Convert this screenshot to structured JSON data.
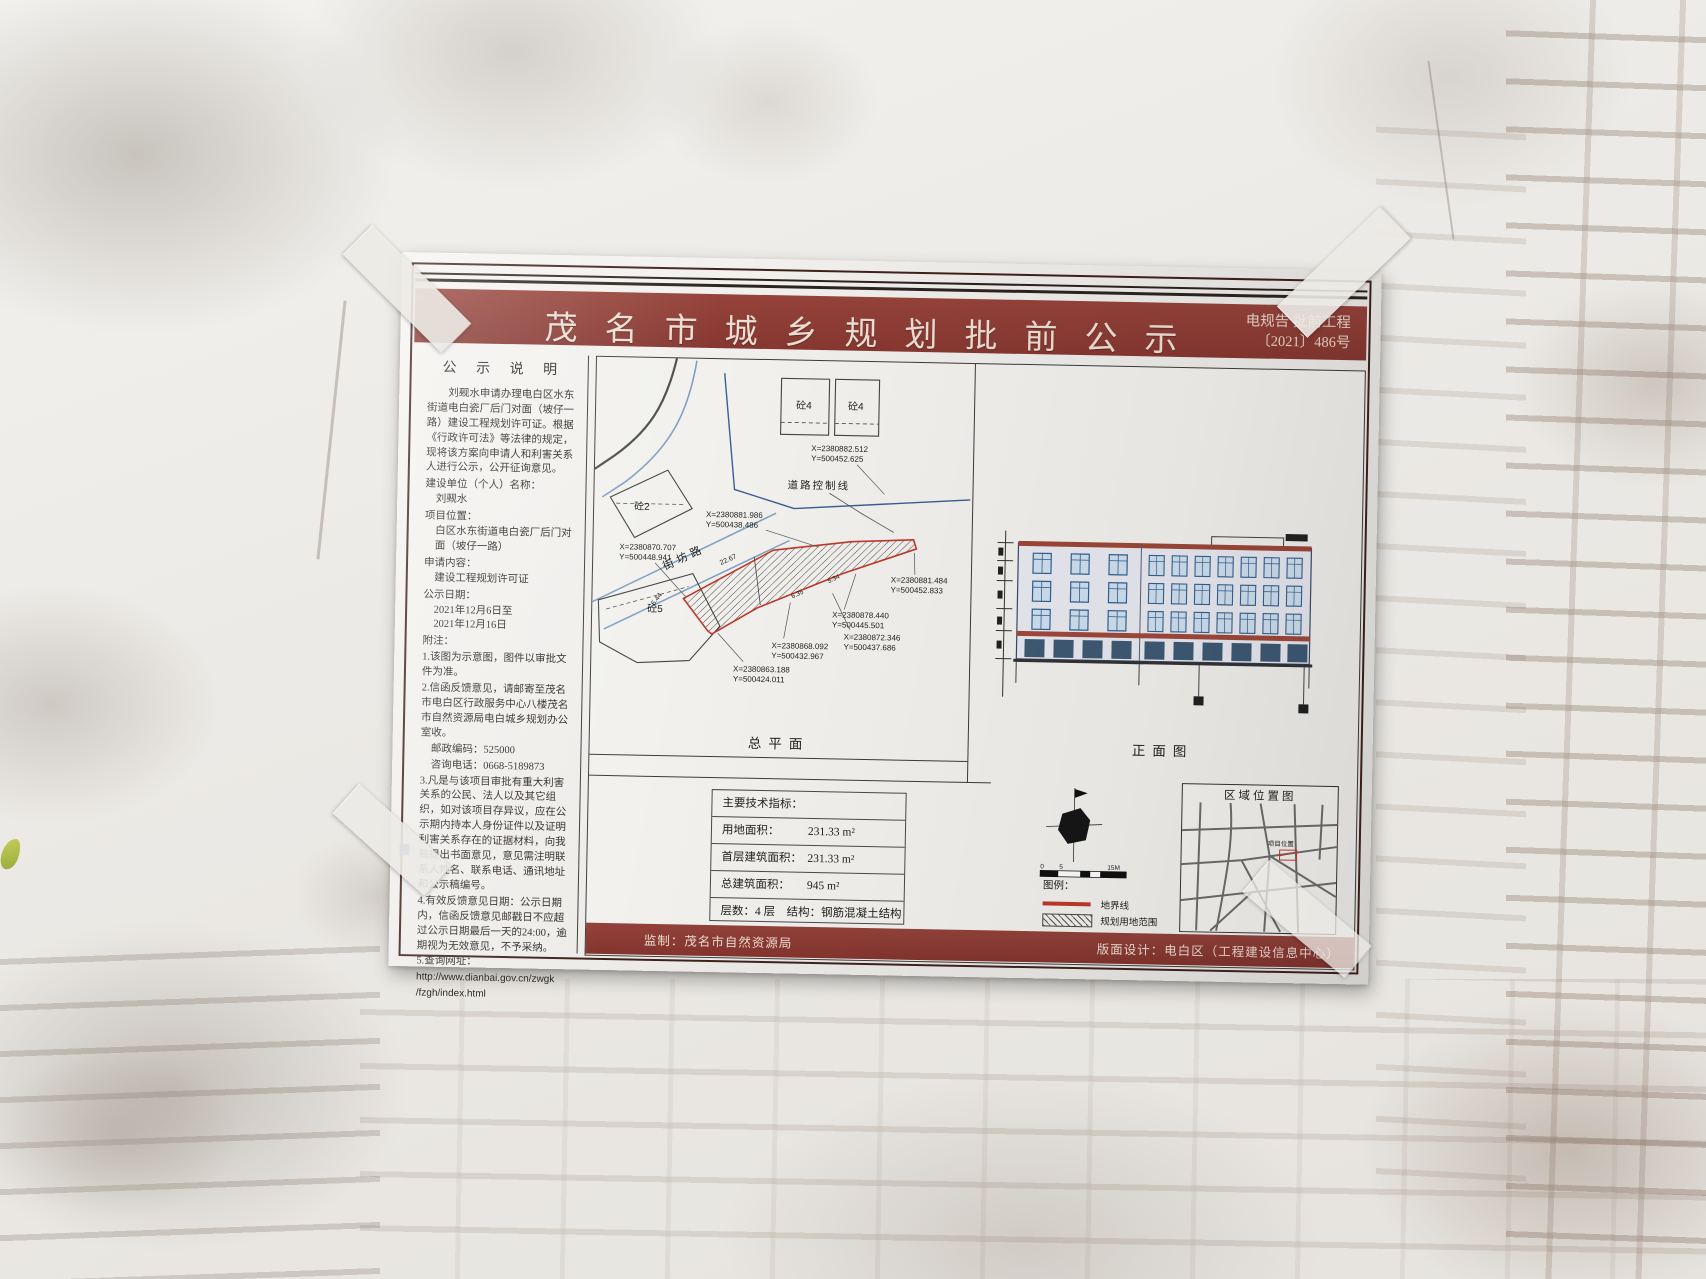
{
  "header": {
    "title": "茂名市城乡规划批前公示",
    "doc_line1": "电规告 批前工程",
    "doc_line2": "〔2021〕486号"
  },
  "left": {
    "heading": "公 示 说 明",
    "intro": "刘觋水申请办理电白区水东街道电白瓷厂后门对面（坡仔一路）建设工程规划许可证。根据《行政许可法》等法律的规定，现将该方案向申请人和利害关系人进行公示，公开征询意见。",
    "unit_label": "建设单位（个人）名称：",
    "unit_value": "刘觋水",
    "loc_label": "项目位置：",
    "loc_value": "白区水东街道电白瓷厂后门对面（坡仔一路）",
    "content_label": "申请内容：",
    "content_value": "建设工程规划许可证",
    "date_label": "公示日期：",
    "date_value1": "2021年12月6日至",
    "date_value2": "2021年12月16日",
    "notes_title": "附注：",
    "notes": [
      "1.该图为示意图，图件以审批文件为准。",
      "2.信函反馈意见，请邮寄至茂名市电白区行政服务中心八楼茂名市自然资源局电白城乡规划办公室收。",
      "邮政编码：525000",
      "咨询电话：0668-5189873",
      "3.凡是与该项目审批有重大利害关系的公民、法人以及其它组织，如对该项目存异议，应在公示期内持本人身份证件以及证明利害关系存在的证据材料，向我局提出书面意见，意见需注明联系人姓名、联系电话、通讯地址和公示稿编号。",
      "4.有效反馈意见日期：公示日期内，信函反馈意见邮戳日不应超过公示日期最后一天的24:00，逾期视为无效意见，不予采纳。",
      "5.查询网址：",
      "http://www.dianbai.gov.cn/zwgk",
      "/fzgh/index.html"
    ]
  },
  "plan": {
    "caption": "总平面",
    "road_name": "街坊路",
    "control_line": "道路控制线",
    "b2": "砼2",
    "b4a": "砼4",
    "b4b": "砼4",
    "b5": "砼5",
    "dims": {
      "d1": "22.67",
      "d2": "6.44",
      "d3": "6.35",
      "d4": "5.34"
    },
    "coords": [
      {
        "x": "X=2380882.512",
        "y": "Y=500452.625"
      },
      {
        "x": "X=2380881.986",
        "y": "Y=500438.486"
      },
      {
        "x": "X=2380870.707",
        "y": "Y=500448.941"
      },
      {
        "x": "X=2380881.484",
        "y": "Y=500452.833"
      },
      {
        "x": "X=2380878.440",
        "y": "Y=500445.501"
      },
      {
        "x": "X=2380872.346",
        "y": "Y=500437.686"
      },
      {
        "x": "X=2380868.092",
        "y": "Y=500432.967"
      },
      {
        "x": "X=2380863.188",
        "y": "Y=500424.011"
      }
    ]
  },
  "elevation": {
    "caption": "正面图"
  },
  "tech": {
    "title": "主要技术指标：",
    "r1_label": "用地面积：",
    "r1_value": "231.33 m²",
    "r2_label": "首层建筑面积：",
    "r2_value": "231.33 m²",
    "r3_label": "总建筑面积：",
    "r3_value": "945 m²",
    "r4": "层数：4 层　结构：钢筋混凝土结构"
  },
  "legend": {
    "title": "图例：",
    "boundary": "地界线",
    "area": "规划用地范围",
    "scale0": "0",
    "scale1": "5",
    "scale2": "15M"
  },
  "region_map": {
    "title": "区域位置图",
    "marker": "项目位置"
  },
  "footer": {
    "left": "监制：茂名市自然资源局",
    "right": "版面设计：电白区（工程建设信息中心）"
  },
  "colors": {
    "title_band": "#8e3b33",
    "boundary_red": "#c0392b"
  }
}
